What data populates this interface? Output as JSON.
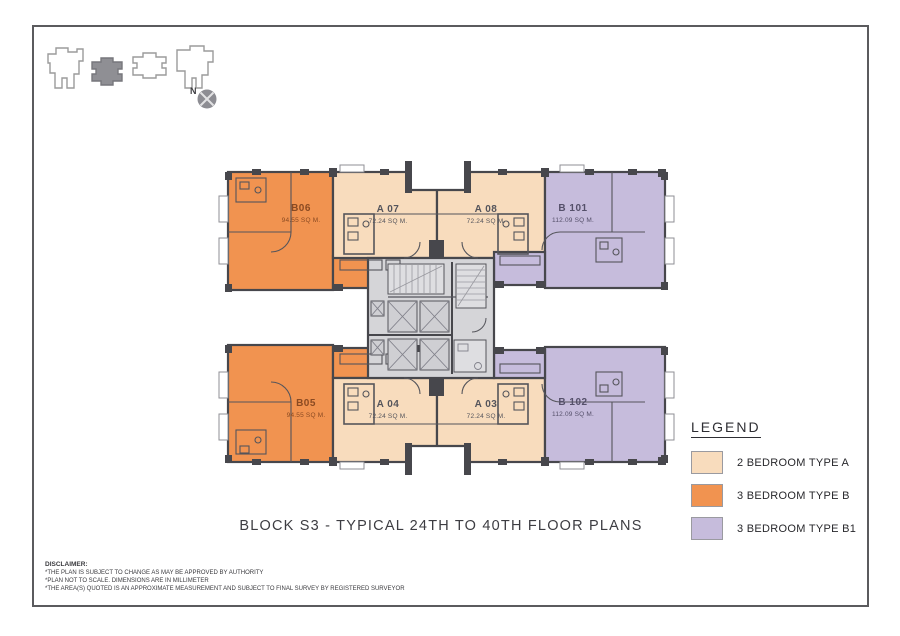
{
  "page": {
    "title": "BLOCK S3 - TYPICAL 24TH TO 40TH FLOOR PLANS"
  },
  "compass": {
    "label": "N"
  },
  "legend": {
    "title": "LEGEND",
    "items": [
      {
        "label": "2 BEDROOM TYPE A",
        "color": "#f8dcbd"
      },
      {
        "label": "3 BEDROOM TYPE B",
        "color": "#f19350"
      },
      {
        "label": "3 BEDROOM TYPE B1",
        "color": "#c6bcdc"
      }
    ]
  },
  "plan": {
    "units": [
      {
        "id": "B06",
        "area": "94.55 SQ M.",
        "type": "3 BEDROOM TYPE B"
      },
      {
        "id": "A 07",
        "area": "72.24 SQ M.",
        "type": "2 BEDROOM TYPE A"
      },
      {
        "id": "A 08",
        "area": "72.24 SQ M.",
        "type": "2 BEDROOM TYPE A"
      },
      {
        "id": "B 101",
        "area": "112.09 SQ M.",
        "type": "3 BEDROOM TYPE B1"
      },
      {
        "id": "B05",
        "area": "94.55 SQ M.",
        "type": "3 BEDROOM TYPE B"
      },
      {
        "id": "A 04",
        "area": "72.24 SQ M.",
        "type": "2 BEDROOM TYPE A"
      },
      {
        "id": "A 03",
        "area": "72.24 SQ M.",
        "type": "2 BEDROOM TYPE A"
      },
      {
        "id": "B 102",
        "area": "112.09 SQ M.",
        "type": "3 BEDROOM TYPE B1"
      }
    ],
    "core_label": "lift-and-stair-core"
  },
  "disclaimer": {
    "heading": "DISCLAIMER:",
    "lines": [
      "*THE PLAN IS SUBJECT TO CHANGE AS MAY BE APPROVED BY AUTHORITY",
      "*PLAN NOT TO SCALE. DIMENSIONS ARE IN MILLIMETER",
      "*THE AREA(S) QUOTED IS AN APPROXIMATE MEASUREMENT AND SUBJECT TO FINAL SURVEY BY REGISTERED SURVEYOR"
    ]
  },
  "colors": {
    "type_a_peach": "#f8dcbd",
    "type_b_orange": "#f19350",
    "type_b1_purple": "#c6bcdc",
    "core_gray": "#d5d5d8",
    "wall_dark": "#47474c"
  }
}
